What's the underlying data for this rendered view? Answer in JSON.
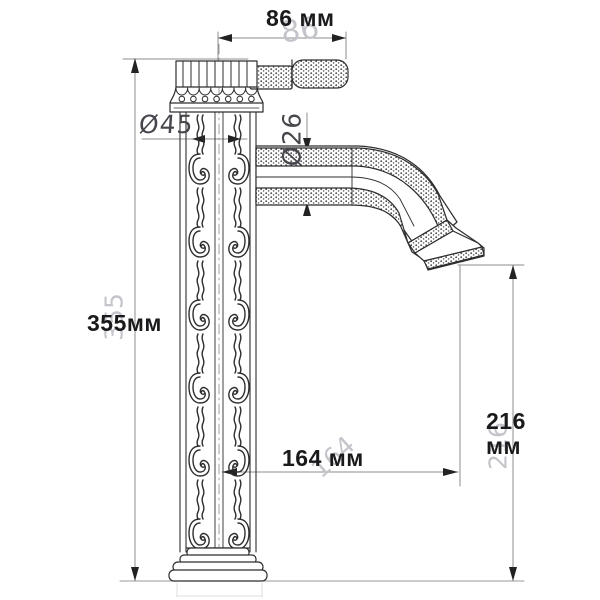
{
  "drawing": {
    "subject": "single-handle vessel faucet, front elevation technical drawing",
    "units": "мм"
  },
  "labels": {
    "width_top": "86 мм",
    "width_top_ghost": "86",
    "body_diameter": "Ø45",
    "spout_diameter": "Ø26",
    "height_total": "355мм",
    "height_total_ghost": "355",
    "spout_reach": "164 мм",
    "spout_reach_ghost": "164",
    "spout_height_value": "216",
    "spout_height_unit": "мм",
    "spout_height_ghost": "216"
  },
  "colors": {
    "background": "#ffffff",
    "drawing_line": "#2e2e2e",
    "dimension_line": "#8c8c8c",
    "dimension_text": "#1a1a1c",
    "ghost_text": "#c4c4cb",
    "tech_label_text": "#46464c"
  }
}
